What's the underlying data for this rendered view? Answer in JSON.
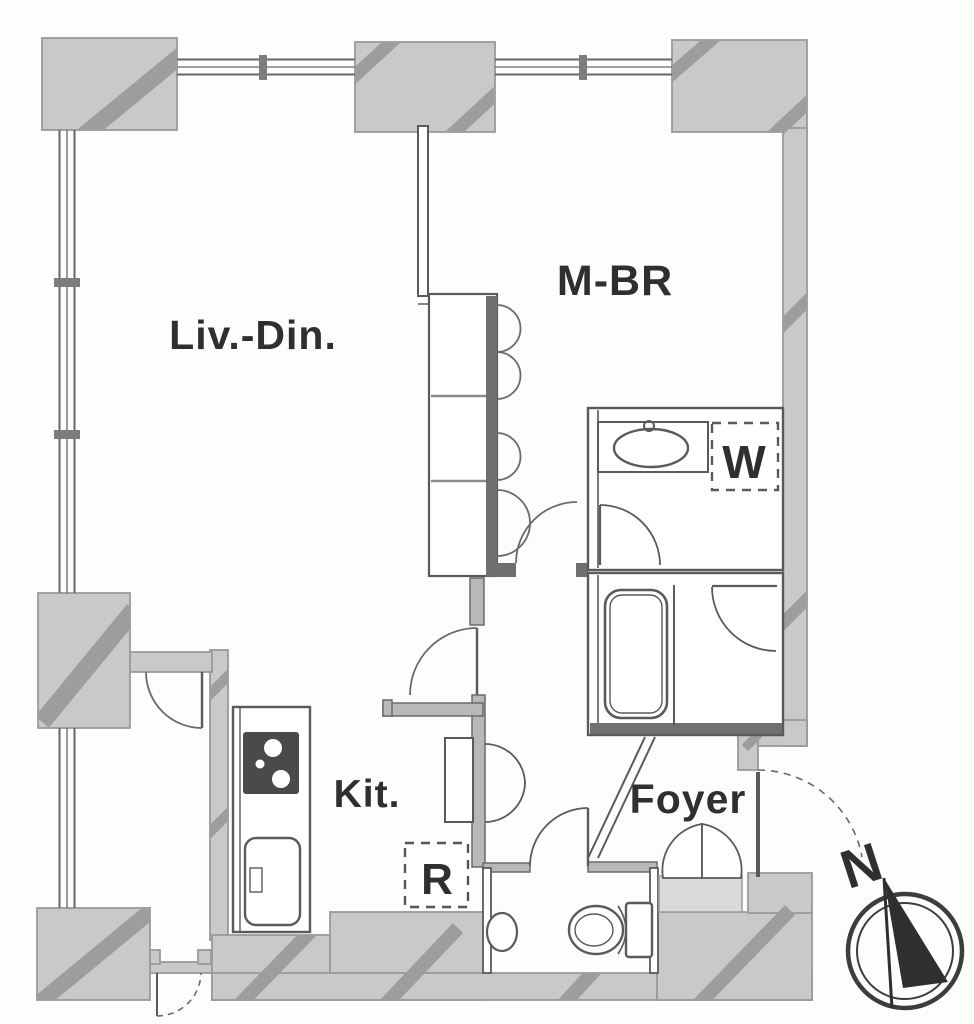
{
  "plan": {
    "rooms": {
      "living_dining": "Liv.-Din.",
      "master_bedroom": "M-BR",
      "kitchen": "Kit.",
      "foyer": "Foyer"
    },
    "markers": {
      "washing_machine": "W",
      "refrigerator": "R"
    },
    "compass": {
      "north": "N"
    },
    "colors": {
      "wall_fill": "#c9c9c9",
      "wall_stripe": "#9d9d9d",
      "wall_dark_bar": "#6f6f6f",
      "line": "#5a5a5a",
      "label_text": "#2f2f2f",
      "background": "#fdfdfc"
    }
  }
}
